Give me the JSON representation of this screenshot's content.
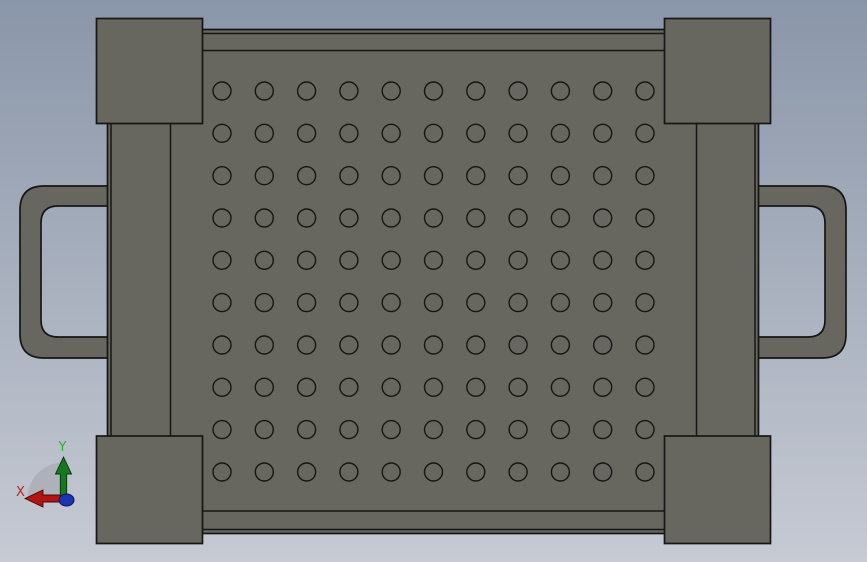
{
  "viewport": {
    "description": "CAD front view of a perforated tray / basket with side handles and corner bumpers",
    "background_top": "#8A96A9",
    "background_bottom": "#C6CAD3"
  },
  "model": {
    "name": "perforated-tray-front-view",
    "body_color": "#67665F",
    "edge_color": "#161614",
    "hole_grid": {
      "rows": 10,
      "cols": 11,
      "start_x": 222,
      "start_y": 91,
      "spacing_x": 42.3,
      "spacing_y": 42.33,
      "radius": 9
    }
  },
  "triad": {
    "x_label": "X",
    "y_label": "Y",
    "x_axis_color": "#B21414",
    "x_label_color": "#C42020",
    "y_axis_color": "#157A1E",
    "y_label_color": "#28B428",
    "z_color": "#1C33B2",
    "arc_color": "#A7ABB2"
  }
}
